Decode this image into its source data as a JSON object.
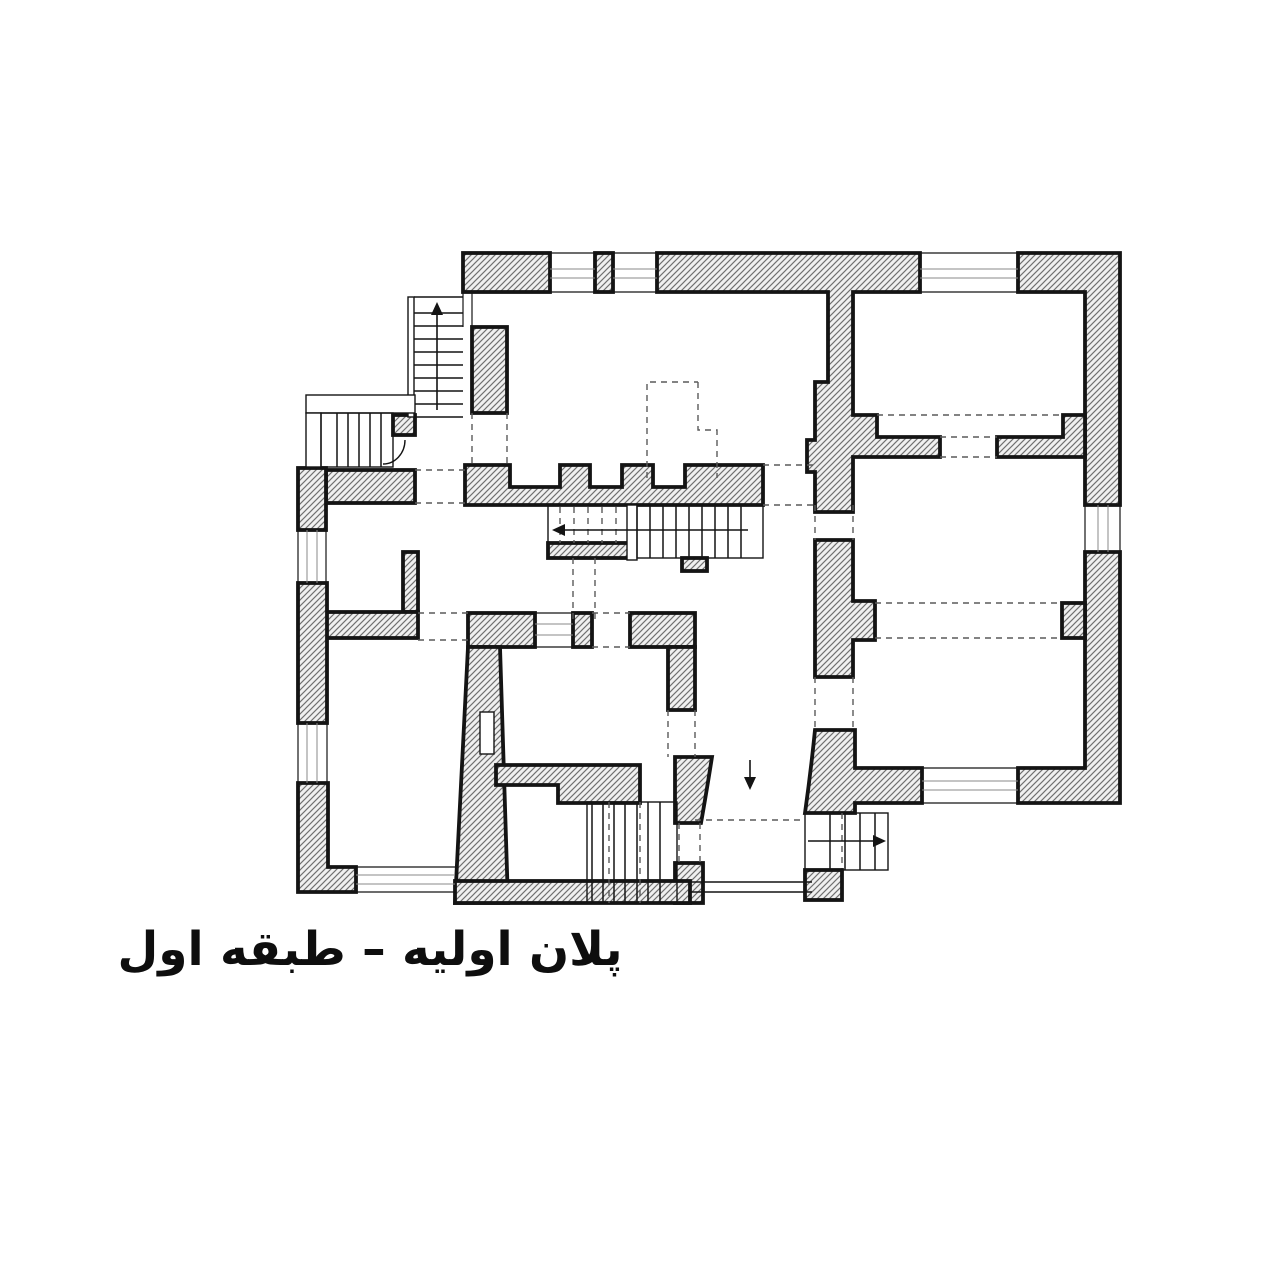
{
  "canvas": {
    "width": 1280,
    "height": 1280,
    "background": "#ffffff"
  },
  "caption": {
    "text": "پلان اولیه – طبقه اول",
    "lang": "fa",
    "direction": "rtl"
  },
  "palette": {
    "line": "#141414",
    "dash": "#5a5a5a",
    "hatch_line": "#6f6f6f",
    "hatch_bg": "#f0f0f0",
    "white": "#ffffff"
  },
  "plan": {
    "type": "architectural-floor-plan",
    "wall_fill": "diagonal-hatch",
    "stairs": [
      {
        "id": "stair-exterior-north-west",
        "treads": 8,
        "arrow": "up"
      },
      {
        "id": "stair-entry-west",
        "treads": 5,
        "arrow": "none"
      },
      {
        "id": "stair-hall-center-west",
        "treads": 6,
        "arrow": "left"
      },
      {
        "id": "stair-hall-center-east",
        "treads": 8,
        "arrow": "none"
      },
      {
        "id": "stair-south-west",
        "treads": 7,
        "arrow": "none"
      },
      {
        "id": "stair-south-east",
        "treads": 4,
        "arrow": "right"
      }
    ],
    "window_count": 10,
    "rooms": [
      "room-north-west",
      "room-north-east",
      "room-east-middle",
      "room-south-east",
      "hall-center",
      "room-west-small",
      "room-west-large",
      "room-inner-south",
      "room-south-small",
      "corridor-south"
    ]
  }
}
